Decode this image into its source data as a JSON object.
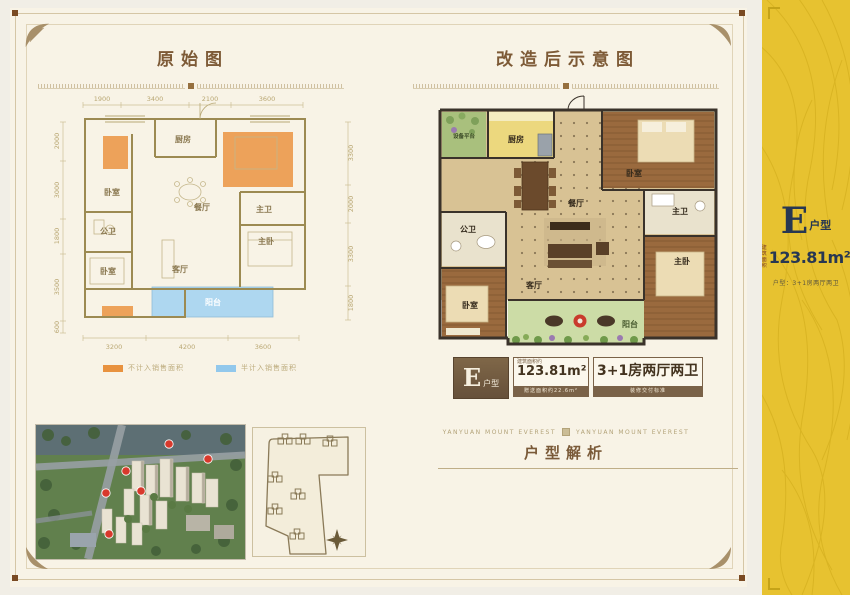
{
  "page": {
    "left_title": "原始图",
    "right_title": "改造后示意图",
    "analysis_title": "户型解析",
    "brand_left": "YANYUAN  MOUNT EVEREST",
    "brand_right": "YANYUAN  MOUNT EVEREST"
  },
  "left_plan": {
    "dims_top": [
      "1900",
      "3400",
      "2100",
      "3600"
    ],
    "dims_bottom": [
      "3200",
      "4200",
      "3600"
    ],
    "dims_left": [
      "2000",
      "3000",
      "1800",
      "3500",
      "600"
    ],
    "dims_right": [
      "3300",
      "2000",
      "3300",
      "1800"
    ],
    "rooms": {
      "kitchen": "厨房",
      "bedroom1": "卧室",
      "dining": "餐厅",
      "bath_public": "公卫",
      "bedroom2": "卧室",
      "living": "客厅",
      "bath_master": "主卫",
      "master_bedroom": "主卧",
      "balcony": "阳台"
    }
  },
  "legend": {
    "items": [
      {
        "color": "#e8923f",
        "label": "不计入销售面积"
      },
      {
        "color": "#92c8ec",
        "label": "半计入销售面积"
      }
    ]
  },
  "right_plan": {
    "rooms": {
      "platform": "设备平台",
      "kitchen": "厨房",
      "bedroom1": "卧室",
      "dining": "餐厅",
      "bath_public": "公卫",
      "bedroom2": "卧室",
      "living": "客厅",
      "bath_master": "主卫",
      "master_bedroom": "主卧",
      "balcony": "阳台"
    }
  },
  "badges": {
    "type_e": "E",
    "type_suffix": "户型",
    "area_caption": "建筑面积约",
    "area_value": "123.81m²",
    "area_sub": "赠送面积约22.6m²",
    "layout_value": "3+1房两厅两卫",
    "layout_sub": "装修交付标准"
  },
  "side_panel": {
    "type_e": "E",
    "type_suffix": "户型",
    "area_prefix_1": "建筑",
    "area_prefix_2": "面积",
    "area_value": "123.81m²",
    "spec": "户型：3+1房两厅两卫",
    "accent_color": "#e7c230"
  },
  "colors": {
    "not_counted_area": "#e8923f",
    "half_counted_area": "#92c8ec",
    "panel_yellow": "#e7c230",
    "title_brown": "#7d5a36"
  }
}
